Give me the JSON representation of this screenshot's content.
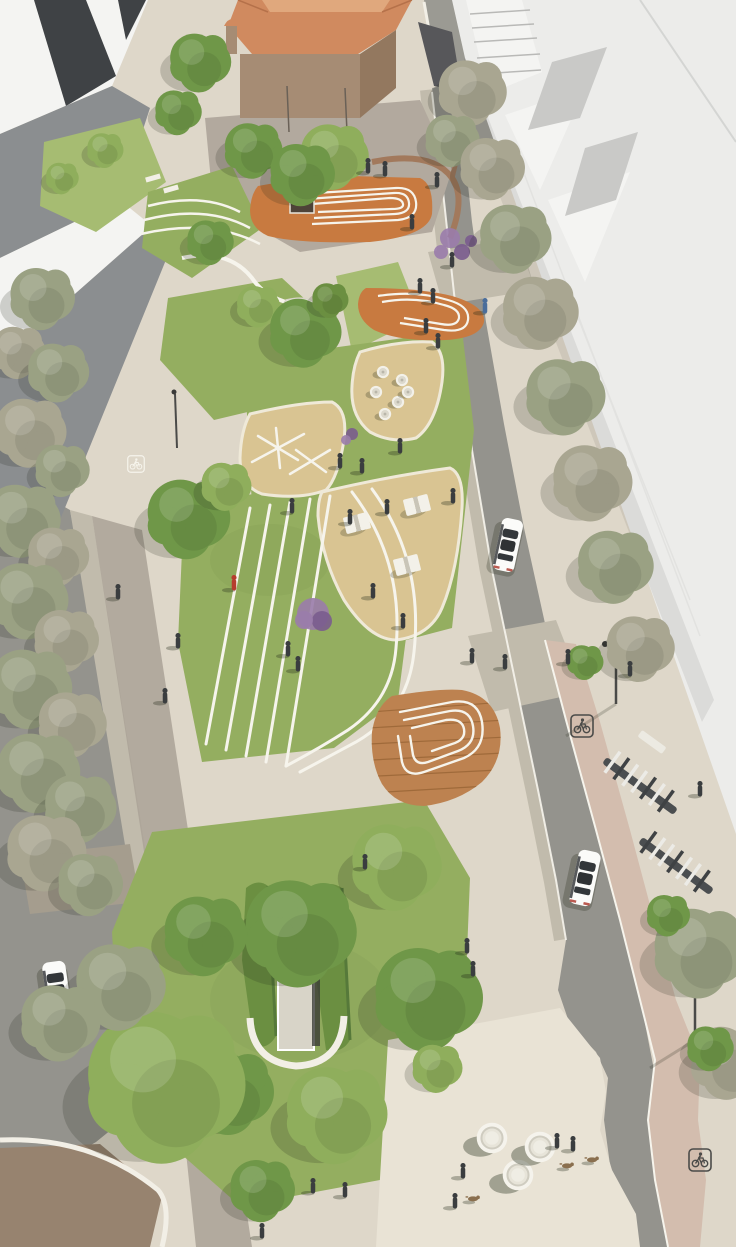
{
  "image": {
    "description": "Aerial architectural rendering of a linear urban park boulevard flanked by tree-lined streets, white buildings, a terracotta-roofed church with plaza, lawns with curved white paths, sand play areas, timber decks, a green-roofed underground entrance, bike lanes and a bike-share station"
  },
  "palette": {
    "base": "#ded7c9",
    "path_light": "#e9e3d5",
    "walk_shade": "#aaa296",
    "paver": "#c1bbac",
    "paver_dark": "#a59d8e",
    "brick": "#97836f",
    "curb": "#f2efe6",
    "white_line": "#f6f4ec",
    "asphalt": "#94938d",
    "asphalt_top": "#9b9a93",
    "bikelane": "#d3bdae",
    "lawn": "#94ae60",
    "lawn_light": "#a6bc72",
    "lawn_dark": "#7e9c50",
    "hedge": "#6b8f41",
    "hedge_dark": "#56793a",
    "sand": "#d9c492",
    "deck": "#c87a40",
    "wood": "#bd8250",
    "wood_dark": "#9f6a3a",
    "church_roof": "#d08a5f",
    "church_roof_light": "#e0a87d",
    "church_wall": "#a68c74",
    "church_wall_dark": "#93785f",
    "plaza": "#b2a99e",
    "flower": "#9a7cab",
    "flower_dark": "#7a5c8e",
    "bldg_white": "#f4f4f2",
    "bldg_light": "#ececea",
    "bldg_mid": "#c9c9c7",
    "bldg_gray": "#8b8e90",
    "bldg_dark": "#3f4245",
    "tree_green": "#6f9748",
    "tree_green_light": "#8fae5c",
    "tree_olive": "#9aa183",
    "tree_gray": "#a9a691",
    "pot_green": "#86a33f",
    "car": "#fbfbf9",
    "car_glass": "#33373a",
    "person": "#3a3d3f",
    "person_red": "#b63c2e",
    "person_blue": "#4a6d9b",
    "dog": "#8a6f4e",
    "wall_brown": "#a2795c",
    "concrete": "#d8d4c8",
    "dark_opening": "#35363a",
    "marking_dark": "#4b4b49",
    "shadow": "#1e2414"
  },
  "scene": {
    "trees": [
      [
        42,
        298,
        36,
        "tree_olive"
      ],
      [
        18,
        352,
        30,
        "tree_gray"
      ],
      [
        58,
        372,
        34,
        "tree_olive"
      ],
      [
        30,
        432,
        40,
        "tree_gray"
      ],
      [
        62,
        470,
        30,
        "tree_olive"
      ],
      [
        22,
        520,
        42,
        "tree_olive"
      ],
      [
        58,
        556,
        34,
        "tree_gray"
      ],
      [
        28,
        600,
        44,
        "tree_olive"
      ],
      [
        66,
        640,
        36,
        "tree_gray"
      ],
      [
        30,
        688,
        46,
        "tree_olive"
      ],
      [
        72,
        724,
        38,
        "tree_gray"
      ],
      [
        38,
        772,
        46,
        "tree_olive"
      ],
      [
        80,
        808,
        40,
        "tree_olive"
      ],
      [
        46,
        852,
        44,
        "tree_gray"
      ],
      [
        90,
        884,
        36,
        "tree_olive"
      ],
      [
        200,
        62,
        34,
        "tree_green"
      ],
      [
        178,
        112,
        26,
        "tree_green"
      ],
      [
        105,
        150,
        20,
        "tree_green_light"
      ],
      [
        62,
        178,
        18,
        "tree_green_light"
      ],
      [
        472,
        92,
        38,
        "tree_gray"
      ],
      [
        452,
        140,
        30,
        "tree_olive"
      ],
      [
        492,
        168,
        36,
        "tree_gray"
      ],
      [
        515,
        238,
        40,
        "tree_olive"
      ],
      [
        540,
        312,
        42,
        "tree_gray"
      ],
      [
        565,
        396,
        44,
        "tree_olive"
      ],
      [
        592,
        482,
        44,
        "tree_gray"
      ],
      [
        615,
        566,
        42,
        "tree_olive"
      ],
      [
        640,
        648,
        38,
        "tree_gray"
      ],
      [
        700,
        952,
        52,
        "tree_olive"
      ],
      [
        728,
        1062,
        42,
        "tree_gray"
      ],
      [
        668,
        915,
        24,
        "tree_green"
      ],
      [
        710,
        1048,
        26,
        "tree_green"
      ],
      [
        585,
        662,
        20,
        "tree_green"
      ],
      [
        253,
        150,
        32,
        "tree_green"
      ],
      [
        334,
        156,
        38,
        "tree_green_light"
      ],
      [
        210,
        242,
        26,
        "tree_green"
      ],
      [
        302,
        174,
        36,
        "tree_green"
      ],
      [
        258,
        306,
        24,
        "tree_green_light"
      ],
      [
        305,
        332,
        40,
        "tree_green"
      ],
      [
        330,
        300,
        20,
        "hedge"
      ],
      [
        188,
        518,
        46,
        "tree_green"
      ],
      [
        226,
        486,
        28,
        "tree_green_light"
      ],
      [
        300,
        932,
        62,
        "tree_green"
      ],
      [
        396,
        866,
        50,
        "tree_green_light"
      ],
      [
        428,
        998,
        60,
        "tree_green"
      ],
      [
        336,
        1114,
        56,
        "tree_green_light"
      ],
      [
        230,
        1092,
        48,
        "tree_green"
      ],
      [
        165,
        1085,
        88,
        "tree_green_light"
      ],
      [
        120,
        986,
        50,
        "tree_olive"
      ],
      [
        60,
        1022,
        44,
        "tree_olive"
      ],
      [
        205,
        935,
        46,
        "tree_green"
      ],
      [
        437,
        1068,
        28,
        "tree_green_light"
      ],
      [
        262,
        1190,
        36,
        "tree_green"
      ]
    ],
    "people": [
      [
        368,
        172
      ],
      [
        385,
        175
      ],
      [
        437,
        186
      ],
      [
        412,
        228
      ],
      [
        452,
        266
      ],
      [
        420,
        292
      ],
      [
        433,
        302
      ],
      [
        485,
        312,
        "person_blue"
      ],
      [
        426,
        332
      ],
      [
        438,
        347
      ],
      [
        400,
        452
      ],
      [
        340,
        467
      ],
      [
        362,
        472
      ],
      [
        292,
        512
      ],
      [
        234,
        589,
        "person_red"
      ],
      [
        288,
        655
      ],
      [
        298,
        670
      ],
      [
        373,
        597
      ],
      [
        403,
        627
      ],
      [
        178,
        647
      ],
      [
        165,
        702
      ],
      [
        118,
        598
      ],
      [
        350,
        523
      ],
      [
        387,
        513
      ],
      [
        453,
        502
      ],
      [
        505,
        668
      ],
      [
        472,
        662
      ],
      [
        568,
        663
      ],
      [
        630,
        675
      ],
      [
        700,
        795
      ],
      [
        365,
        868
      ],
      [
        467,
        952
      ],
      [
        473,
        975
      ],
      [
        313,
        1192
      ],
      [
        345,
        1196
      ],
      [
        262,
        1237
      ],
      [
        557,
        1147
      ],
      [
        573,
        1150
      ],
      [
        463,
        1177
      ],
      [
        455,
        1207
      ]
    ],
    "dogs": [
      [
        567,
        1168
      ],
      [
        592,
        1162
      ],
      [
        473,
        1201
      ]
    ],
    "cones": [
      [
        383,
        372
      ],
      [
        402,
        380
      ],
      [
        376,
        392
      ],
      [
        398,
        402
      ],
      [
        385,
        414
      ],
      [
        408,
        392
      ]
    ],
    "tables": [
      [
        357,
        523,
        -14
      ],
      [
        417,
        505,
        -14
      ],
      [
        407,
        565,
        -14
      ]
    ],
    "planters": [
      [
        492,
        1138
      ],
      [
        518,
        1175
      ],
      [
        540,
        1147
      ]
    ],
    "markings": [
      [
        582,
        726,
        1,
        "marking_dark"
      ],
      [
        700,
        1160,
        1,
        "marking_dark"
      ],
      [
        136,
        464,
        0.75,
        "white_line"
      ]
    ],
    "cars": [
      [
        508,
        545,
        12,
        1.2
      ],
      [
        585,
        878,
        12,
        1.25
      ],
      [
        57,
        990,
        -8,
        1.3
      ]
    ],
    "flowers": [
      [
        450,
        238,
        10,
        "flower"
      ],
      [
        462,
        252,
        8,
        "flower_dark"
      ],
      [
        441,
        252,
        7,
        "flower"
      ],
      [
        471,
        241,
        6,
        "flower_dark"
      ],
      [
        313,
        614,
        16,
        "flower"
      ],
      [
        322,
        621,
        10,
        "flower_dark"
      ],
      [
        304,
        620,
        9,
        "flower"
      ],
      [
        352,
        434,
        6,
        "flower_dark"
      ],
      [
        346,
        440,
        5,
        "flower"
      ]
    ]
  }
}
